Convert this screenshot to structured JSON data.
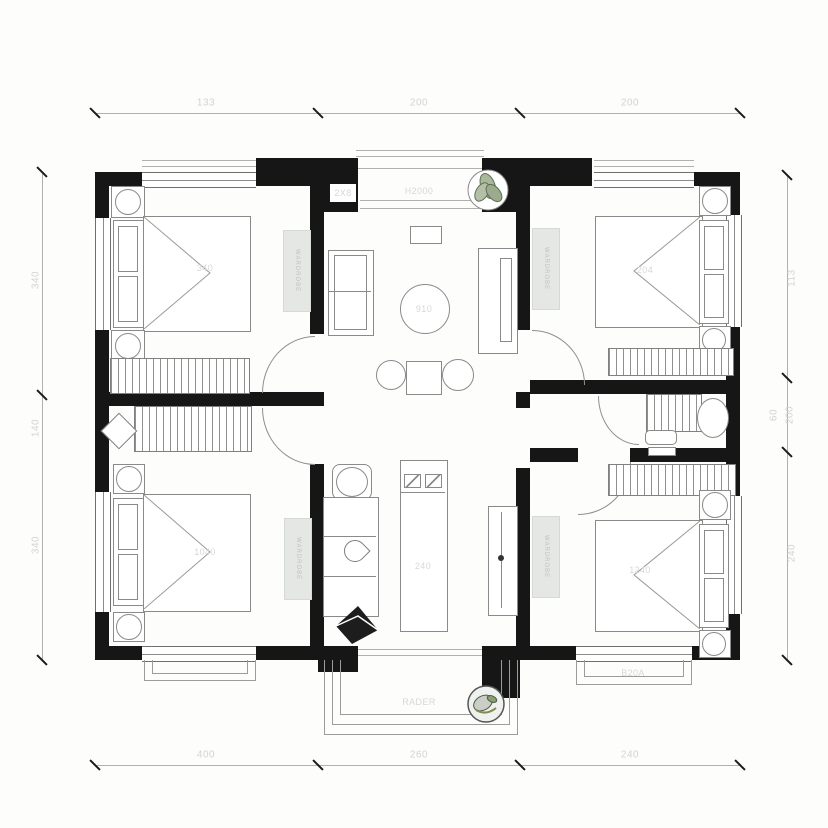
{
  "plan_type": "apartment-floor-plan",
  "dims": {
    "top": [
      "133",
      "200",
      "200"
    ],
    "bottom": [
      "400",
      "260",
      "240"
    ],
    "left": [
      "340",
      "140",
      "340"
    ],
    "right": [
      "113",
      "60",
      "200",
      "240"
    ]
  },
  "rooms": {
    "tl": {
      "label": "340",
      "wardrobe": "WARDROBE"
    },
    "tr": {
      "label": "204",
      "wardrobe": "WARDROBE"
    },
    "bl": {
      "label": "1040",
      "wardrobe": "WARDROBE"
    },
    "br": {
      "label": "1240",
      "wardrobe": "WARDROBE"
    },
    "living": {
      "table_label": "910"
    },
    "kitchen": {
      "island_label": "240"
    },
    "balcony_top": {
      "label": "H2000",
      "side_label": "2X8"
    },
    "balcony_bottom": {
      "label": "RADER"
    },
    "window_br": {
      "label": "B20A"
    }
  },
  "icons": {
    "plant_top": "potted-plant-icon",
    "plant_bottom": "potted-plant-icon"
  },
  "colors": {
    "wall": "#161616",
    "furniture_line": "#8a8a8a",
    "faint_text": "#d3d3d3",
    "wardrobe_fill": "#e5e7e4",
    "plant_green": "#a9b79a"
  }
}
